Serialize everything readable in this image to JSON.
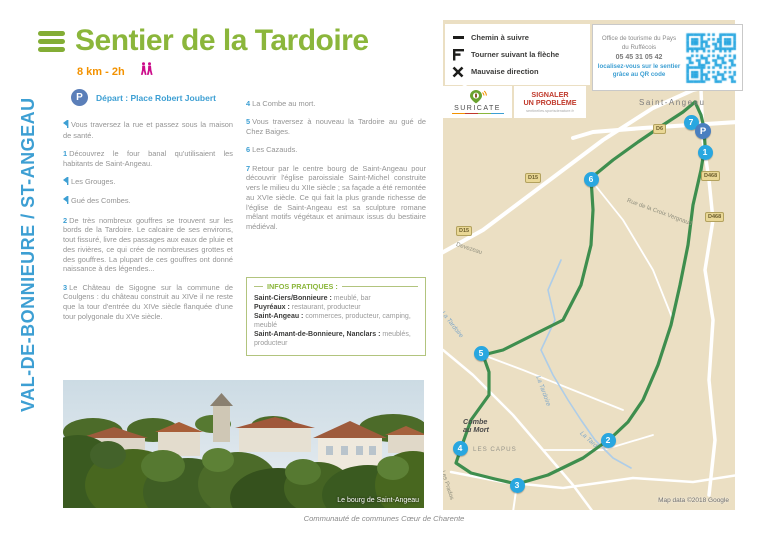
{
  "page": {
    "title": "Sentier de la Tardoire",
    "distance_duration": "8 km - 2h",
    "depart_parking": "P",
    "depart": "Départ : Place Robert Joubert",
    "sidebar_vertical": "VAL-DE-BONNIEURE / ST-ANGEAU",
    "footer": "Communauté de communes Cœur de Charente"
  },
  "steps_col1": [
    {
      "marker": "turn",
      "text": "Vous traversez la rue et passez sous la maison de santé."
    },
    {
      "marker": "1",
      "text": "Découvrez le four banal qu'utilisaient les habitants de Saint-Angeau."
    },
    {
      "marker": "turn",
      "text": "Les Grouges."
    },
    {
      "marker": "turn",
      "text": "Gué des Combes."
    },
    {
      "marker": "2",
      "text": "De très nombreux gouffres se trouvent sur les bords de la Tardoire. Le calcaire de ses environs, tout fissuré, livre des passages aux eaux de pluie et des rivières, ce qui crée de nombreuses grottes et des gouffres. La plupart de ces gouffres ont donné naissance à des légendes..."
    },
    {
      "marker": "3",
      "text": "Le Château de Sigogne sur la commune de Coulgens : du château construit au XIVe il ne reste que la tour d'entrée du XIVe siècle flanquée d'une tour polygonale du XVe siècle."
    }
  ],
  "steps_col2": [
    {
      "marker": "4",
      "text": "La Combe au mort."
    },
    {
      "marker": "5",
      "text": "Vous traversez à nouveau la Tardoire au gué de Chez Baiges."
    },
    {
      "marker": "6",
      "text": "Les Cazauds."
    },
    {
      "marker": "7",
      "text": "Retour par le centre bourg de Saint-Angeau pour découvrir l'église paroissiale Saint-Michel construite vers le milieu du XIIe siècle ; sa façade a été remontée au XVIe siècle. Ce qui fait la plus grande richesse de l'église de Saint-Angeau est sa sculpture romane mêlant motifs végétaux et animaux issus du bestiaire médiéval."
    }
  ],
  "legend": {
    "items": [
      {
        "icon": "dash",
        "label": "Chemin à suivre"
      },
      {
        "icon": "turn-flag",
        "label": "Tourner suivant la flèche"
      },
      {
        "icon": "cross",
        "label": "Mauvaise direction"
      }
    ]
  },
  "tourism_office": {
    "line1": "Office de tourisme du Pays",
    "line2": "du Ruffécois",
    "phone": "05 45 31 05 42",
    "qr_line1": "localisez-vous sur le sentier",
    "qr_line2": "grâce au QR code"
  },
  "suricate": {
    "name": "SURICATE",
    "report_line1": "SIGNALER",
    "report_line2": "UN PROBLÈME",
    "url": "sentinelles.sportsdenature.fr"
  },
  "infos_pratiques": {
    "title": "INFOS PRATIQUES :",
    "entries": [
      {
        "name": "Saint-Ciers/Bonnieure",
        "details": "meublé, bar"
      },
      {
        "name": "Puyréaux",
        "details": "restaurant, producteur"
      },
      {
        "name": "Saint-Angeau",
        "details": "commerces, producteur, camping, meublé"
      },
      {
        "name": "Saint-Amant-de-Bonnieure, Nanclars",
        "details": "meublés, producteur"
      }
    ]
  },
  "photo": {
    "caption": "Le bourg de Saint-Angeau"
  },
  "map": {
    "attribution": "Map data ©2018 Google",
    "markers": [
      {
        "label": "7",
        "x": 248,
        "y": 102,
        "type": "num"
      },
      {
        "label": "P",
        "x": 260,
        "y": 111,
        "type": "p"
      },
      {
        "label": "1",
        "x": 262,
        "y": 132,
        "type": "num"
      },
      {
        "label": "6",
        "x": 148,
        "y": 159,
        "type": "num"
      },
      {
        "label": "5",
        "x": 38,
        "y": 333,
        "type": "num"
      },
      {
        "label": "4",
        "x": 17,
        "y": 428,
        "type": "num"
      },
      {
        "label": "2",
        "x": 165,
        "y": 420,
        "type": "num"
      },
      {
        "label": "3",
        "x": 74,
        "y": 465,
        "type": "num"
      }
    ],
    "labels": [
      {
        "text": "Saint-Angeau",
        "x": 196,
        "y": 78,
        "rot": 0,
        "cls": "ml-town"
      },
      {
        "text": "Combe\nau Mort",
        "x": 20,
        "y": 398,
        "rot": 0,
        "cls": "ml-place"
      },
      {
        "text": "LES CAPUS",
        "x": 30,
        "y": 426,
        "rot": 0,
        "cls": "ml-caps"
      },
      {
        "text": "La Tardoire",
        "x": 98,
        "y": 355,
        "rot": 70,
        "cls": "ml-river"
      },
      {
        "text": "La Tardoire",
        "x": 2,
        "y": 290,
        "rot": 52,
        "cls": "ml-river"
      },
      {
        "text": "La Tard",
        "x": 140,
        "y": 410,
        "rot": 42,
        "cls": "ml-river"
      },
      {
        "text": "Devezeau",
        "x": 14,
        "y": 222,
        "rot": 18,
        "cls": "ml-road"
      },
      {
        "text": "Les Prados",
        "x": 2,
        "y": 450,
        "rot": 72,
        "cls": "ml-road"
      },
      {
        "text": "Rue de la Croix Vergnaud",
        "x": 185,
        "y": 178,
        "rot": 20,
        "cls": "ml-road"
      }
    ],
    "badges": [
      {
        "text": "D6",
        "x": 210,
        "y": 104
      },
      {
        "text": "D15",
        "x": 82,
        "y": 153
      },
      {
        "text": "D15",
        "x": 13,
        "y": 206
      },
      {
        "text": "D468",
        "x": 258,
        "y": 151
      },
      {
        "text": "D468",
        "x": 262,
        "y": 192
      }
    ],
    "trail": {
      "color": "#3e8e4e",
      "west": [
        [
          252,
          82
        ],
        [
          240,
          92
        ],
        [
          220,
          105
        ],
        [
          195,
          122
        ],
        [
          170,
          140
        ],
        [
          148,
          158
        ],
        [
          150,
          190
        ],
        [
          148,
          225
        ],
        [
          138,
          265
        ],
        [
          120,
          300
        ],
        [
          60,
          330
        ],
        [
          40,
          335
        ],
        [
          46,
          352
        ],
        [
          46,
          375
        ],
        [
          28,
          400
        ],
        [
          18,
          428
        ],
        [
          13,
          443
        ],
        [
          28,
          453
        ],
        [
          52,
          459
        ],
        [
          74,
          464
        ]
      ],
      "east": [
        [
          252,
          82
        ],
        [
          258,
          95
        ],
        [
          261,
          108
        ],
        [
          262,
          125
        ],
        [
          258,
          150
        ],
        [
          250,
          185
        ],
        [
          245,
          225
        ],
        [
          237,
          265
        ],
        [
          228,
          305
        ],
        [
          215,
          345
        ],
        [
          200,
          380
        ],
        [
          185,
          402
        ],
        [
          168,
          418
        ],
        [
          140,
          438
        ],
        [
          105,
          455
        ],
        [
          74,
          464
        ]
      ]
    },
    "river": {
      "color": "#aecde8",
      "points": [
        [
          118,
          240
        ],
        [
          105,
          270
        ],
        [
          112,
          300
        ],
        [
          98,
          330
        ],
        [
          110,
          355
        ],
        [
          125,
          380
        ],
        [
          138,
          400
        ],
        [
          152,
          420
        ],
        [
          170,
          438
        ],
        [
          188,
          448
        ]
      ]
    },
    "roads": [
      {
        "w": 4,
        "points": [
          [
            -5,
            235
          ],
          [
            40,
            210
          ],
          [
            100,
            165
          ],
          [
            160,
            120
          ],
          [
            210,
            88
          ],
          [
            250,
            70
          ],
          [
            295,
            60
          ]
        ]
      },
      {
        "w": 4,
        "points": [
          [
            130,
            118
          ],
          [
            150,
            112
          ],
          [
            200,
            108
          ],
          [
            295,
            102
          ]
        ]
      },
      {
        "w": 3.5,
        "points": [
          [
            262,
            18
          ],
          [
            258,
            70
          ],
          [
            260,
            120
          ],
          [
            266,
            160
          ],
          [
            270,
            200
          ],
          [
            262,
            250
          ],
          [
            270,
            300
          ],
          [
            266,
            360
          ],
          [
            272,
            420
          ],
          [
            266,
            475
          ]
        ]
      },
      {
        "w": 2.5,
        "points": [
          [
            0,
            330
          ],
          [
            30,
            355
          ],
          [
            70,
            395
          ],
          [
            100,
            430
          ],
          [
            130,
            465
          ],
          [
            150,
            492
          ]
        ]
      },
      {
        "w": 2.5,
        "points": [
          [
            8,
            452
          ],
          [
            60,
            462
          ],
          [
            120,
            468
          ],
          [
            190,
            458
          ],
          [
            250,
            462
          ],
          [
            295,
            455
          ]
        ]
      },
      {
        "w": 2,
        "points": [
          [
            74,
            464
          ],
          [
            70,
            492
          ]
        ]
      },
      {
        "w": 2,
        "points": [
          [
            0,
            80
          ],
          [
            60,
            40
          ],
          [
            120,
            10
          ]
        ]
      },
      {
        "w": 1.8,
        "points": [
          [
            148,
            160
          ],
          [
            180,
            200
          ],
          [
            210,
            250
          ],
          [
            230,
            300
          ]
        ]
      },
      {
        "w": 1.8,
        "points": [
          [
            40,
            335
          ],
          [
            80,
            350
          ],
          [
            130,
            370
          ],
          [
            180,
            390
          ]
        ]
      },
      {
        "w": 1.8,
        "points": [
          [
            100,
            430
          ],
          [
            160,
            430
          ],
          [
            210,
            415
          ]
        ]
      }
    ]
  },
  "colors": {
    "brand_green": "#8bb63b",
    "brand_blue": "#3d9fd3",
    "accent_orange": "#f39200",
    "accent_magenta": "#cc0c8a",
    "alert_red": "#c0392b",
    "map_bg": "#ebdfc3",
    "trail_green": "#3e8e4e",
    "marker_blue": "#29a7e0",
    "parking_blue": "#4a7fc0"
  }
}
